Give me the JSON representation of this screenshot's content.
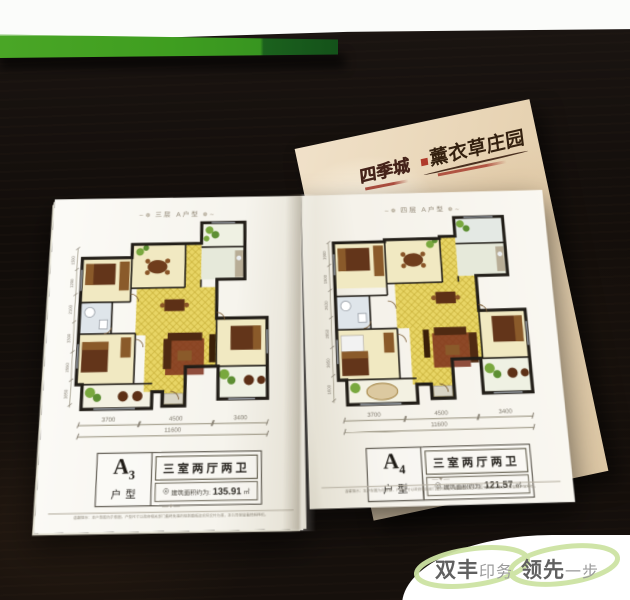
{
  "cover": {
    "brand": "四季城",
    "title": "薰衣草庄园"
  },
  "pages": {
    "left": {
      "header": "三层 A户型",
      "header_ornament_left": "∼❁",
      "header_ornament_right": "❁∼",
      "unit_code": "A",
      "unit_num": "3",
      "unit_label": "户型",
      "rooms": "三室两厅两卫",
      "area_icon": "◎",
      "area_label": "建筑面积约为:",
      "area_value": "135.91",
      "area_unit": "㎡",
      "dims_bottom": {
        "s1": "3700",
        "s2": "4500",
        "s3": "3400",
        "total": "11600"
      },
      "dims_left": [
        "1500",
        "1200",
        "2100",
        "3300",
        "2550",
        "3850"
      ],
      "foot_ornament": "—✦—",
      "disclaimer": "温馨提示：本户型图为示意图，户型尺寸以政府相关部门最终批准的规划图纸及实际交付为准，本公司保留最终解释权。"
    },
    "right": {
      "header": "四层 A户型",
      "header_ornament_left": "∼❁",
      "header_ornament_right": "❁∼",
      "unit_code": "A",
      "unit_num": "4",
      "unit_label": "户型",
      "rooms": "三室两厅两卫",
      "area_icon": "◎",
      "area_label": "建筑面积约为:",
      "area_value": "121.57",
      "area_unit": "㎡",
      "dims_bottom": {
        "s1": "3700",
        "s2": "4500",
        "s3": "3400",
        "total": "11600"
      },
      "dims_left": [
        "1900",
        "1500",
        "2600",
        "2850",
        "3850",
        "1600"
      ],
      "foot_ornament": "—✦—",
      "disclaimer": "温馨提示：本户型图为示意图，户型尺寸以政府相关部门最终批准的规划图纸及实际交付为准，本公司保留最终解释权。"
    }
  },
  "watermark": {
    "bold1": "双丰",
    "light1": "印务",
    "bold2": "领先",
    "light2": "一步"
  },
  "colors": {
    "box_green": "#3f9e20",
    "parchment": "#e9d6b4",
    "plan_yellow": "#e8d565",
    "watermark_green": "#cde3a3",
    "table": "#17120e"
  }
}
